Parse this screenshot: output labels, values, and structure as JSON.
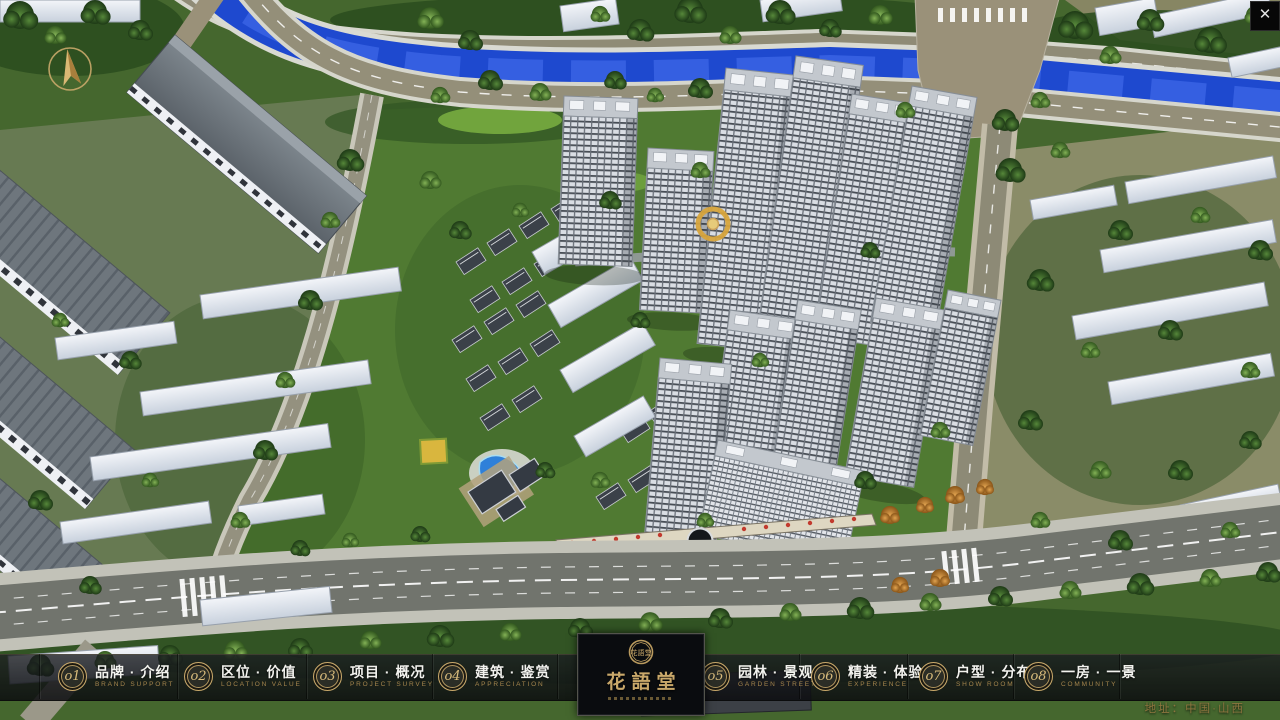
{
  "app": {
    "close_glyph": "✕",
    "address": "地址：中国·山西"
  },
  "nav": {
    "items": [
      {
        "num": "o1",
        "zh": "品牌 · 介绍",
        "en": "BRAND SUPPORT"
      },
      {
        "num": "o2",
        "zh": "区位 · 价值",
        "en": "LOCATION VALUE"
      },
      {
        "num": "o3",
        "zh": "项目 · 概况",
        "en": "PROJECT SURVEY"
      },
      {
        "num": "o4",
        "zh": "建筑 · 鉴赏",
        "en": "APPRECIATION"
      },
      {
        "num": "o5",
        "zh": "园林 · 景观",
        "en": "GARDEN STREET"
      },
      {
        "num": "o6",
        "zh": "精装 · 体验",
        "en": "EXPERIENCE"
      },
      {
        "num": "o7",
        "zh": "户型 · 分布",
        "en": "SHOW ROOM"
      },
      {
        "num": "o8",
        "zh": "一房 · 一景",
        "en": "COMMUNITY"
      }
    ],
    "logo": {
      "title": "花語堂",
      "seal": "花語堂"
    }
  },
  "colors": {
    "brand_gold": "#c9a86a",
    "nav_english": "#a5854d",
    "nav_chinese": "#f2f2ee",
    "bar_background": "#14161a",
    "river_blue": "#1e49cf",
    "grass_green": "#45672e"
  }
}
